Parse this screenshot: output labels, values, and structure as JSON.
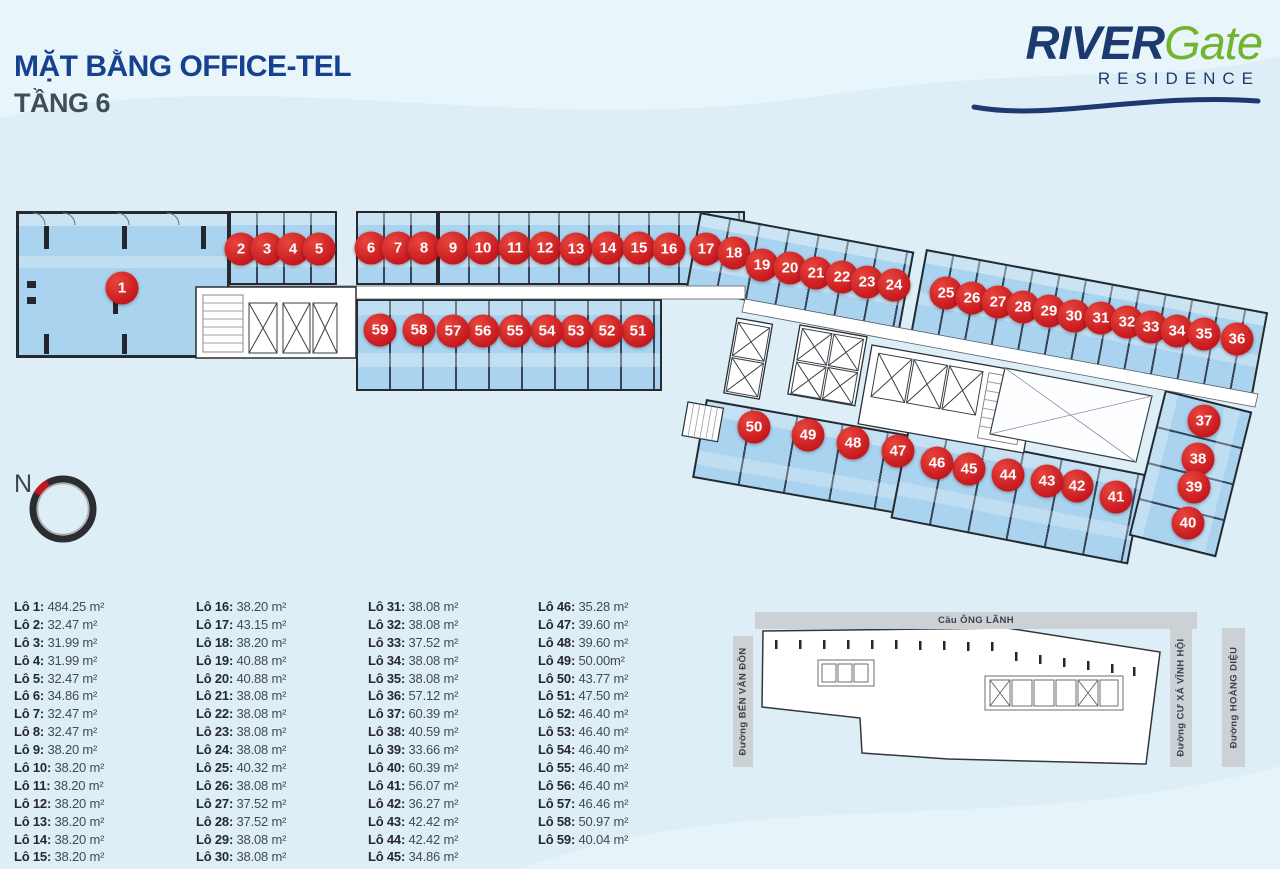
{
  "theme": {
    "accent_red": "#c4161d",
    "unit_blue": "#a9d3ee",
    "navy": "#16418f",
    "slate": "#404d5a",
    "logo_navy": "#1d3a70",
    "logo_green": "#72b42d"
  },
  "header": {
    "title_line1": "MẶT BẰNG OFFICE-TEL",
    "title_line2": "TẦNG 6"
  },
  "logo": {
    "river": "RIVER",
    "gate": "Gate",
    "residence": "RESIDENCE"
  },
  "compass": {
    "label": "N"
  },
  "minimap": {
    "top_road": "Cầu ÔNG LÃNH",
    "left_road": "Đường BẾN VÂN ĐỒN",
    "right_road_1": "Đường CƯ XÁ VĨNH HỘI",
    "right_road_2": "Đường HOÀNG DIỆU"
  },
  "legend": {
    "columns": [
      15,
      15,
      15,
      14
    ],
    "lot_prefix": "Lô"
  },
  "floorplan": {
    "lots": [
      {
        "n": 1,
        "x": 122,
        "y": 288,
        "area": "484.25 m²"
      },
      {
        "n": 2,
        "x": 241,
        "y": 249,
        "area": "32.47 m²"
      },
      {
        "n": 3,
        "x": 267,
        "y": 249,
        "area": "31.99 m²"
      },
      {
        "n": 4,
        "x": 293,
        "y": 249,
        "area": "31.99 m²"
      },
      {
        "n": 5,
        "x": 319,
        "y": 249,
        "area": "32.47 m²"
      },
      {
        "n": 6,
        "x": 371,
        "y": 248,
        "area": "34.86 m²"
      },
      {
        "n": 7,
        "x": 398,
        "y": 248,
        "area": "32.47 m²"
      },
      {
        "n": 8,
        "x": 424,
        "y": 248,
        "area": "32.47 m²"
      },
      {
        "n": 9,
        "x": 453,
        "y": 248,
        "area": "38.20 m²"
      },
      {
        "n": 10,
        "x": 483,
        "y": 248,
        "area": "38.20 m²"
      },
      {
        "n": 11,
        "x": 515,
        "y": 248,
        "area": "38.20 m²"
      },
      {
        "n": 12,
        "x": 545,
        "y": 248,
        "area": "38.20 m²"
      },
      {
        "n": 13,
        "x": 576,
        "y": 249,
        "area": "38.20 m²"
      },
      {
        "n": 14,
        "x": 608,
        "y": 248,
        "area": "38.20 m²"
      },
      {
        "n": 15,
        "x": 639,
        "y": 248,
        "area": "38.20 m²"
      },
      {
        "n": 16,
        "x": 669,
        "y": 249,
        "area": "38.20 m²"
      },
      {
        "n": 17,
        "x": 706,
        "y": 249,
        "area": "43.15 m²"
      },
      {
        "n": 18,
        "x": 734,
        "y": 253,
        "area": "38.20 m²"
      },
      {
        "n": 19,
        "x": 762,
        "y": 265,
        "area": "40.88 m²"
      },
      {
        "n": 20,
        "x": 790,
        "y": 268,
        "area": "40.88 m²"
      },
      {
        "n": 21,
        "x": 816,
        "y": 273,
        "area": "38.08 m²"
      },
      {
        "n": 22,
        "x": 842,
        "y": 277,
        "area": "38.08 m²"
      },
      {
        "n": 23,
        "x": 867,
        "y": 282,
        "area": "38.08 m²"
      },
      {
        "n": 24,
        "x": 894,
        "y": 285,
        "area": "38.08 m²"
      },
      {
        "n": 25,
        "x": 946,
        "y": 293,
        "area": "40.32 m²"
      },
      {
        "n": 26,
        "x": 972,
        "y": 298,
        "area": "38.08 m²"
      },
      {
        "n": 27,
        "x": 998,
        "y": 302,
        "area": "37.52 m²"
      },
      {
        "n": 28,
        "x": 1023,
        "y": 307,
        "area": "37.52 m²"
      },
      {
        "n": 29,
        "x": 1049,
        "y": 311,
        "area": "38.08 m²"
      },
      {
        "n": 30,
        "x": 1074,
        "y": 316,
        "area": "38.08 m²"
      },
      {
        "n": 31,
        "x": 1101,
        "y": 318,
        "area": "38.08 m²"
      },
      {
        "n": 32,
        "x": 1127,
        "y": 322,
        "area": "38.08 m²"
      },
      {
        "n": 33,
        "x": 1151,
        "y": 327,
        "area": "37.52 m²"
      },
      {
        "n": 34,
        "x": 1177,
        "y": 331,
        "area": "38.08 m²"
      },
      {
        "n": 35,
        "x": 1204,
        "y": 334,
        "area": "38.08 m²"
      },
      {
        "n": 36,
        "x": 1237,
        "y": 339,
        "area": "57.12 m²"
      },
      {
        "n": 37,
        "x": 1204,
        "y": 421,
        "area": "60.39 m²"
      },
      {
        "n": 38,
        "x": 1198,
        "y": 459,
        "area": "40.59 m²"
      },
      {
        "n": 39,
        "x": 1194,
        "y": 487,
        "area": "33.66 m²"
      },
      {
        "n": 40,
        "x": 1188,
        "y": 523,
        "area": "60.39 m²"
      },
      {
        "n": 41,
        "x": 1116,
        "y": 497,
        "area": "56.07 m²"
      },
      {
        "n": 42,
        "x": 1077,
        "y": 486,
        "area": "36.27 m²"
      },
      {
        "n": 43,
        "x": 1047,
        "y": 481,
        "area": "42.42 m²"
      },
      {
        "n": 44,
        "x": 1008,
        "y": 475,
        "area": "42.42 m²"
      },
      {
        "n": 45,
        "x": 969,
        "y": 469,
        "area": "34.86 m²"
      },
      {
        "n": 46,
        "x": 937,
        "y": 463,
        "area": "35.28 m²"
      },
      {
        "n": 47,
        "x": 898,
        "y": 451,
        "area": "39.60 m²"
      },
      {
        "n": 48,
        "x": 853,
        "y": 443,
        "area": "39.60 m²"
      },
      {
        "n": 49,
        "x": 808,
        "y": 435,
        "area": "50.00m²"
      },
      {
        "n": 50,
        "x": 754,
        "y": 427,
        "area": "43.77 m²"
      },
      {
        "n": 51,
        "x": 638,
        "y": 331,
        "area": "47.50 m²"
      },
      {
        "n": 52,
        "x": 607,
        "y": 331,
        "area": "46.40 m²"
      },
      {
        "n": 53,
        "x": 576,
        "y": 331,
        "area": "46.40 m²"
      },
      {
        "n": 54,
        "x": 547,
        "y": 331,
        "area": "46.40 m²"
      },
      {
        "n": 55,
        "x": 515,
        "y": 331,
        "area": "46.40 m²"
      },
      {
        "n": 56,
        "x": 483,
        "y": 331,
        "area": "46.40 m²"
      },
      {
        "n": 57,
        "x": 453,
        "y": 331,
        "area": "46.46 m²"
      },
      {
        "n": 58,
        "x": 419,
        "y": 330,
        "area": "50.97 m²"
      },
      {
        "n": 59,
        "x": 380,
        "y": 330,
        "area": "40.04 m²"
      }
    ]
  }
}
